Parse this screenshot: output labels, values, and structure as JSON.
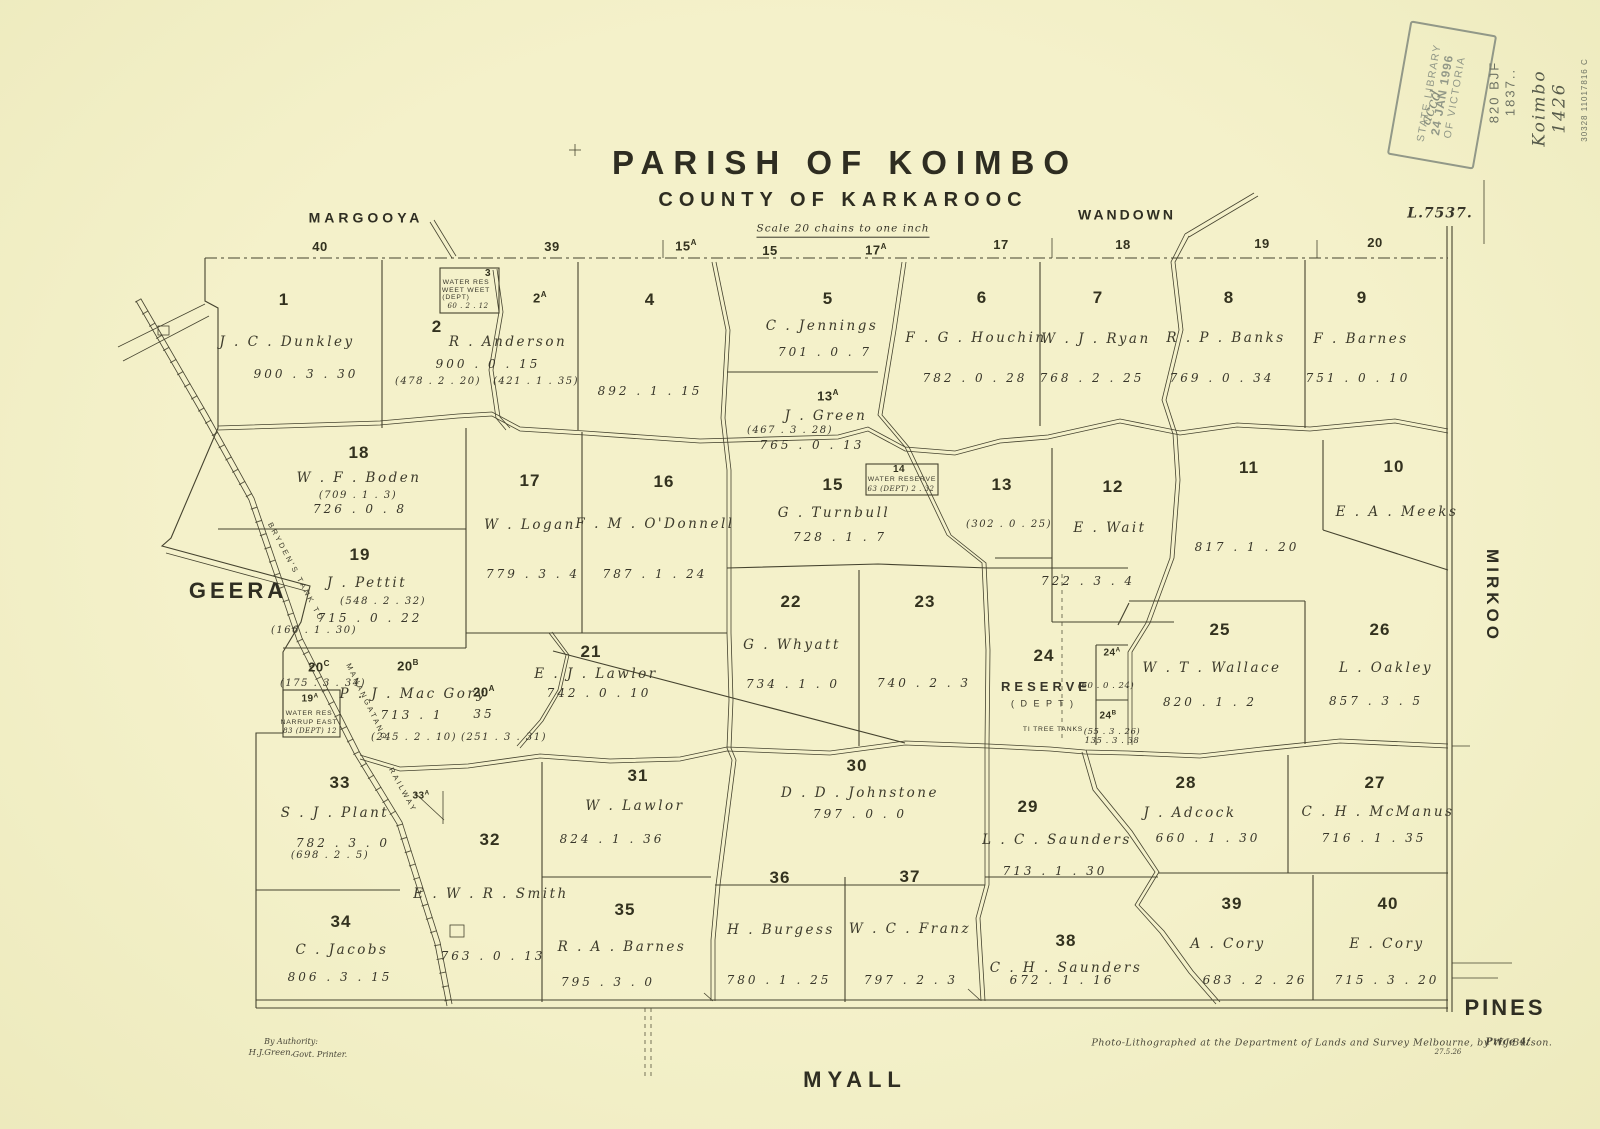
{
  "header": {
    "title": "PARISH OF KOIMBO",
    "subtitle": "COUNTY OF KARKAROOC",
    "scale_note": "Scale 20 chains to one inch",
    "plan_ref": "L.7537."
  },
  "stamp": {
    "line1": "STATE LIBRARY",
    "line2": "24 JAN 1996",
    "line3": "OF VICTORIA",
    "script": "accd"
  },
  "annotations": {
    "call_number": "820 BJF",
    "call_number2": "1837..",
    "pencil_name": "Koimbo",
    "pencil_year": "1426",
    "barcode": "30328 11017816 C"
  },
  "adjoining_parishes": {
    "top_left": "MARGOOYA",
    "top_right": "WANDOWN",
    "left": "GEERA",
    "right": "MIRKOO",
    "bottom": "MYALL",
    "bottom_right": "PINES"
  },
  "adjoining_numbers": [
    {
      "t": "40"
    },
    {
      "t": "39"
    },
    {
      "t": "15",
      "suffix": "A"
    },
    {
      "t": "15"
    },
    {
      "t": "17",
      "suffix": "A"
    },
    {
      "t": "17"
    },
    {
      "t": "18"
    },
    {
      "t": "19"
    },
    {
      "t": "20"
    }
  ],
  "railway": {
    "label1": "BRYDEN'S TANK TO",
    "label2": "MANANGATANG",
    "label3": "RAILWAY"
  },
  "parcels": [
    {
      "id": "p1",
      "number": "1",
      "owner": "J . C . Dunkley",
      "area": "900 . 3 . 30"
    },
    {
      "id": "p2",
      "number": "2",
      "owner": "R . Anderson",
      "area": "900 . 0 . 15",
      "alt": "(478 . 2 . 20)"
    },
    {
      "id": "p2a",
      "number": "2",
      "suffix": "A",
      "alt": "(421 . 1 . 35)"
    },
    {
      "id": "p3",
      "number": "3",
      "res1": "WATER RES",
      "res2": "WEET WEET",
      "res3": "(DEPT)",
      "area": "60 . 2 . 12"
    },
    {
      "id": "p4",
      "number": "4",
      "area": "892 . 1 . 15"
    },
    {
      "id": "p5",
      "number": "5",
      "owner": "C . Jennings",
      "area": "701 . 0 . 7"
    },
    {
      "id": "p6",
      "number": "6",
      "owner": "F . G . Houchin",
      "area": "782 . 0 . 28"
    },
    {
      "id": "p7",
      "number": "7",
      "owner": "W . J . Ryan",
      "area": "768 . 2 . 25"
    },
    {
      "id": "p8",
      "number": "8",
      "owner": "R . P . Banks",
      "area": "769 . 0 . 34"
    },
    {
      "id": "p9",
      "number": "9",
      "owner": "F . Barnes",
      "area": "751 . 0 . 10"
    },
    {
      "id": "p10",
      "number": "10",
      "owner": "E . A . Meeks"
    },
    {
      "id": "p11",
      "number": "11",
      "area": "817 . 1 . 20"
    },
    {
      "id": "p12",
      "number": "12",
      "owner": "E . Wait",
      "area": "722 . 3 . 4"
    },
    {
      "id": "p13",
      "number": "13",
      "alt": "(302 . 0 . 25)"
    },
    {
      "id": "p13a",
      "number": "13",
      "suffix": "A",
      "owner": "J . Green",
      "alt": "(467 . 3 . 28)",
      "area": "765 . 0 . 13"
    },
    {
      "id": "p14",
      "number": "14",
      "res1": "WATER RESERVE",
      "area": "63 (DEPT) 2 . 32"
    },
    {
      "id": "p15",
      "number": "15",
      "owner": "G . Turnbull",
      "area": "728 . 1 . 7"
    },
    {
      "id": "p16",
      "number": "16",
      "owner": "F . M . O'Donnell",
      "area": "787 . 1 . 24"
    },
    {
      "id": "p17",
      "number": "17",
      "owner": "W . Logan",
      "area": "779 . 3 . 4"
    },
    {
      "id": "p18",
      "number": "18",
      "owner": "W . F . Boden",
      "alt": "(709 . 1 . 3)",
      "area": "726 . 0 . 8"
    },
    {
      "id": "p19",
      "number": "19",
      "owner": "J . Pettit",
      "alt": "(548 . 2 . 32)",
      "area": "715 . 0 . 22",
      "alt2": "(166 . 1 . 30)"
    },
    {
      "id": "p19a",
      "number": "19",
      "suffix": "A",
      "res1": "WATER RES",
      "res2": "NARRUP EAST",
      "area": "83 (DEPT) 12"
    },
    {
      "id": "p20c",
      "number": "20",
      "suffix": "C",
      "alt": "(175 . 3 . 34)"
    },
    {
      "id": "p20b",
      "number": "20",
      "suffix": "B",
      "owner": "P . J . Mac Gory",
      "area": "713 . 1",
      "alt": "(245 . 2 . 10)"
    },
    {
      "id": "p20a",
      "number": "20",
      "suffix": "A",
      "area": "35",
      "alt": "(251 . 3 . 31)"
    },
    {
      "id": "p21",
      "number": "21",
      "owner": "E . J . Lawlor",
      "area": "742 . 0 . 10"
    },
    {
      "id": "p22",
      "number": "22",
      "owner": "G . Whyatt",
      "area": "734 . 1 . 0"
    },
    {
      "id": "p23",
      "number": "23",
      "area": "740 . 2 . 3"
    },
    {
      "id": "p24",
      "number": "24",
      "owner": "RESERVE",
      "alt": "( D E P T )",
      "res1": "TI TREE TANKS"
    },
    {
      "id": "p24a",
      "number": "24",
      "suffix": "A",
      "alt": "(60 . 0 . 24)"
    },
    {
      "id": "p24b",
      "number": "24",
      "suffix": "B",
      "alt": "(55 . 3 . 26)",
      "area": "135 . 3 . 38"
    },
    {
      "id": "p25",
      "number": "25",
      "owner": "W . T . Wallace",
      "area": "820 . 1 . 2"
    },
    {
      "id": "p26",
      "number": "26",
      "owner": "L . Oakley",
      "area": "857 . 3 . 5"
    },
    {
      "id": "p27",
      "number": "27",
      "owner": "C . H . McManus",
      "area": "716 . 1 . 35"
    },
    {
      "id": "p28",
      "number": "28",
      "owner": "J . Adcock",
      "area": "660 . 1 . 30"
    },
    {
      "id": "p29",
      "number": "29",
      "owner": "L . C . Saunders",
      "area": "713 . 1 . 30"
    },
    {
      "id": "p30",
      "number": "30",
      "owner": "D . D . Johnstone",
      "area": "797 . 0 . 0"
    },
    {
      "id": "p31",
      "number": "31",
      "owner": "W . Lawlor",
      "area": "824 . 1 . 36"
    },
    {
      "id": "p32",
      "number": "32",
      "owner": "E . W . R . Smith",
      "area": "763 . 0 . 13"
    },
    {
      "id": "p33",
      "number": "33",
      "owner": "S . J . Plant",
      "area": "782 . 3 . 0",
      "alt": "(698 . 2 . 5)"
    },
    {
      "id": "p33a",
      "number": "33",
      "suffix": "A"
    },
    {
      "id": "p34",
      "number": "34",
      "owner": "C . Jacobs",
      "area": "806 . 3 . 15"
    },
    {
      "id": "p35",
      "number": "35",
      "owner": "R . A . Barnes",
      "area": "795 . 3 . 0"
    },
    {
      "id": "p36",
      "number": "36",
      "owner": "H . Burgess",
      "area": "780 . 1 . 25"
    },
    {
      "id": "p37",
      "number": "37",
      "owner": "W . C . Franz",
      "area": "797 . 2 . 3"
    },
    {
      "id": "p38",
      "number": "38",
      "owner": "C . H . Saunders",
      "area": "672 . 1 . 16"
    },
    {
      "id": "p39",
      "number": "39",
      "owner": "A . Cory",
      "area": "683 . 2 . 26"
    },
    {
      "id": "p40",
      "number": "40",
      "owner": "E . Cory",
      "area": "715 . 3 . 20"
    }
  ],
  "footer": {
    "authority_line1": "By Authority:",
    "authority_name": "H.J.Green,",
    "authority_role": "Govt. Printer.",
    "litho": "Photo-Lithographed at the Department of Lands and Survey Melbourne, by W.J.Butson.",
    "litho_date": "27.5.26",
    "price": "Price 4/"
  }
}
